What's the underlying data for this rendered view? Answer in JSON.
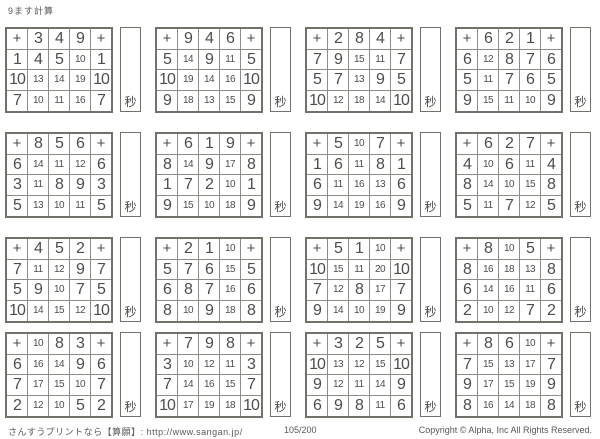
{
  "page": {
    "title": "9ます計算",
    "unit_label": "秒",
    "footer": {
      "site": "さんすうプリントなら【算願】: http://www.sangan.jp/",
      "page_number": "105/200",
      "copyright": "Copyright © Alpha, Inc All Rights Reserved."
    },
    "colors": {
      "answer_red": "#dc4b44",
      "ink": "#4d4d4d",
      "grid_line": "#8d8d85"
    }
  },
  "grids": [
    {
      "operator": "+",
      "top": [
        3,
        4,
        9
      ],
      "left": [
        1,
        10,
        7
      ],
      "answers": [
        [
          4,
          5,
          10
        ],
        [
          13,
          14,
          19
        ],
        [
          10,
          11,
          16
        ]
      ]
    },
    {
      "operator": "+",
      "top": [
        9,
        4,
        6
      ],
      "left": [
        5,
        10,
        9
      ],
      "answers": [
        [
          14,
          9,
          11
        ],
        [
          19,
          14,
          16
        ],
        [
          18,
          13,
          15
        ]
      ]
    },
    {
      "operator": "+",
      "top": [
        2,
        8,
        4
      ],
      "left": [
        7,
        5,
        10
      ],
      "answers": [
        [
          9,
          15,
          11
        ],
        [
          7,
          13,
          9
        ],
        [
          12,
          18,
          14
        ]
      ]
    },
    {
      "operator": "+",
      "top": [
        6,
        2,
        1
      ],
      "left": [
        6,
        5,
        9
      ],
      "answers": [
        [
          12,
          8,
          7
        ],
        [
          11,
          7,
          6
        ],
        [
          15,
          11,
          10
        ]
      ]
    },
    {
      "operator": "+",
      "top": [
        8,
        5,
        6
      ],
      "left": [
        6,
        3,
        5
      ],
      "answers": [
        [
          14,
          11,
          12
        ],
        [
          11,
          8,
          9
        ],
        [
          13,
          10,
          11
        ]
      ]
    },
    {
      "operator": "+",
      "top": [
        6,
        1,
        9
      ],
      "left": [
        8,
        1,
        9
      ],
      "answers": [
        [
          14,
          9,
          17
        ],
        [
          7,
          2,
          10
        ],
        [
          15,
          10,
          18
        ]
      ]
    },
    {
      "operator": "+",
      "top": [
        5,
        10,
        7
      ],
      "left": [
        1,
        6,
        9
      ],
      "answers": [
        [
          6,
          11,
          8
        ],
        [
          11,
          16,
          13
        ],
        [
          14,
          19,
          16
        ]
      ]
    },
    {
      "operator": "+",
      "top": [
        6,
        2,
        7
      ],
      "left": [
        4,
        8,
        5
      ],
      "answers": [
        [
          10,
          6,
          11
        ],
        [
          14,
          10,
          15
        ],
        [
          11,
          7,
          12
        ]
      ]
    },
    {
      "operator": "+",
      "top": [
        4,
        5,
        2
      ],
      "left": [
        7,
        5,
        10
      ],
      "answers": [
        [
          11,
          12,
          9
        ],
        [
          9,
          10,
          7
        ],
        [
          14,
          15,
          12
        ]
      ]
    },
    {
      "operator": "+",
      "top": [
        2,
        1,
        10
      ],
      "left": [
        5,
        6,
        8
      ],
      "answers": [
        [
          7,
          6,
          15
        ],
        [
          8,
          7,
          16
        ],
        [
          10,
          9,
          18
        ]
      ]
    },
    {
      "operator": "+",
      "top": [
        5,
        1,
        10
      ],
      "left": [
        10,
        7,
        9
      ],
      "answers": [
        [
          15,
          11,
          20
        ],
        [
          12,
          8,
          17
        ],
        [
          14,
          10,
          19
        ]
      ]
    },
    {
      "operator": "+",
      "top": [
        8,
        10,
        5
      ],
      "left": [
        8,
        6,
        2
      ],
      "answers": [
        [
          16,
          18,
          13
        ],
        [
          14,
          16,
          11
        ],
        [
          10,
          12,
          7
        ]
      ]
    },
    {
      "operator": "+",
      "top": [
        10,
        8,
        3
      ],
      "left": [
        6,
        7,
        2
      ],
      "answers": [
        [
          16,
          14,
          9
        ],
        [
          17,
          15,
          10
        ],
        [
          12,
          10,
          5
        ]
      ]
    },
    {
      "operator": "+",
      "top": [
        7,
        9,
        8
      ],
      "left": [
        3,
        7,
        10
      ],
      "answers": [
        [
          10,
          12,
          11
        ],
        [
          14,
          16,
          15
        ],
        [
          17,
          19,
          18
        ]
      ]
    },
    {
      "operator": "+",
      "top": [
        3,
        2,
        5
      ],
      "left": [
        10,
        9,
        6
      ],
      "answers": [
        [
          13,
          12,
          15
        ],
        [
          12,
          11,
          14
        ],
        [
          9,
          8,
          11
        ]
      ]
    },
    {
      "operator": "+",
      "top": [
        8,
        6,
        10
      ],
      "left": [
        7,
        9,
        8
      ],
      "answers": [
        [
          15,
          13,
          17
        ],
        [
          17,
          15,
          19
        ],
        [
          16,
          14,
          18
        ]
      ]
    }
  ],
  "layout": {
    "col_x": [
      5,
      155,
      305,
      455
    ],
    "row_y": [
      27,
      132,
      237,
      332
    ]
  }
}
